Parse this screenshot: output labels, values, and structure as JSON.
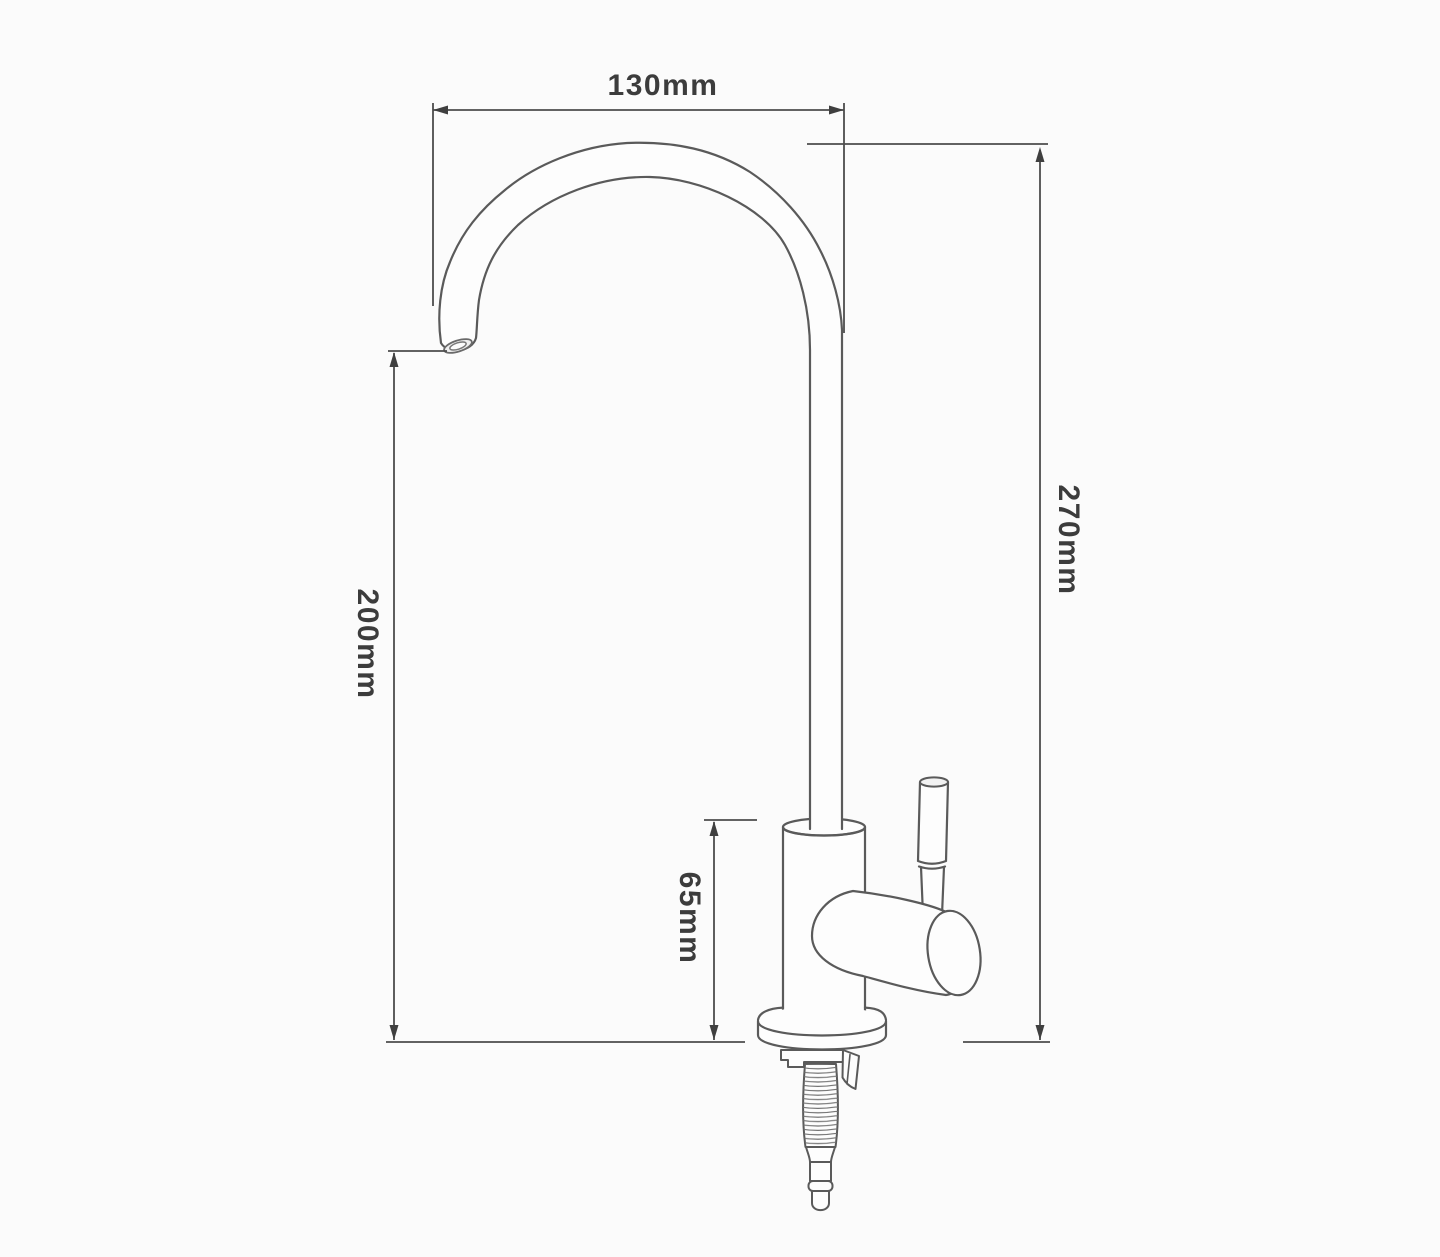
{
  "page": {
    "background_color": "#fbfbfb"
  },
  "drawing": {
    "subject": "Gooseneck drinking-water faucet dimension drawing",
    "line_color": "#5a5a5a",
    "dimension_line_color": "#4d4d4d",
    "label_color": "#3c3c3c",
    "dimensions": {
      "spout_width_label": "130mm",
      "overall_height_label": "270mm",
      "spout_height_label": "200mm",
      "body_height_label": "65mm"
    }
  }
}
